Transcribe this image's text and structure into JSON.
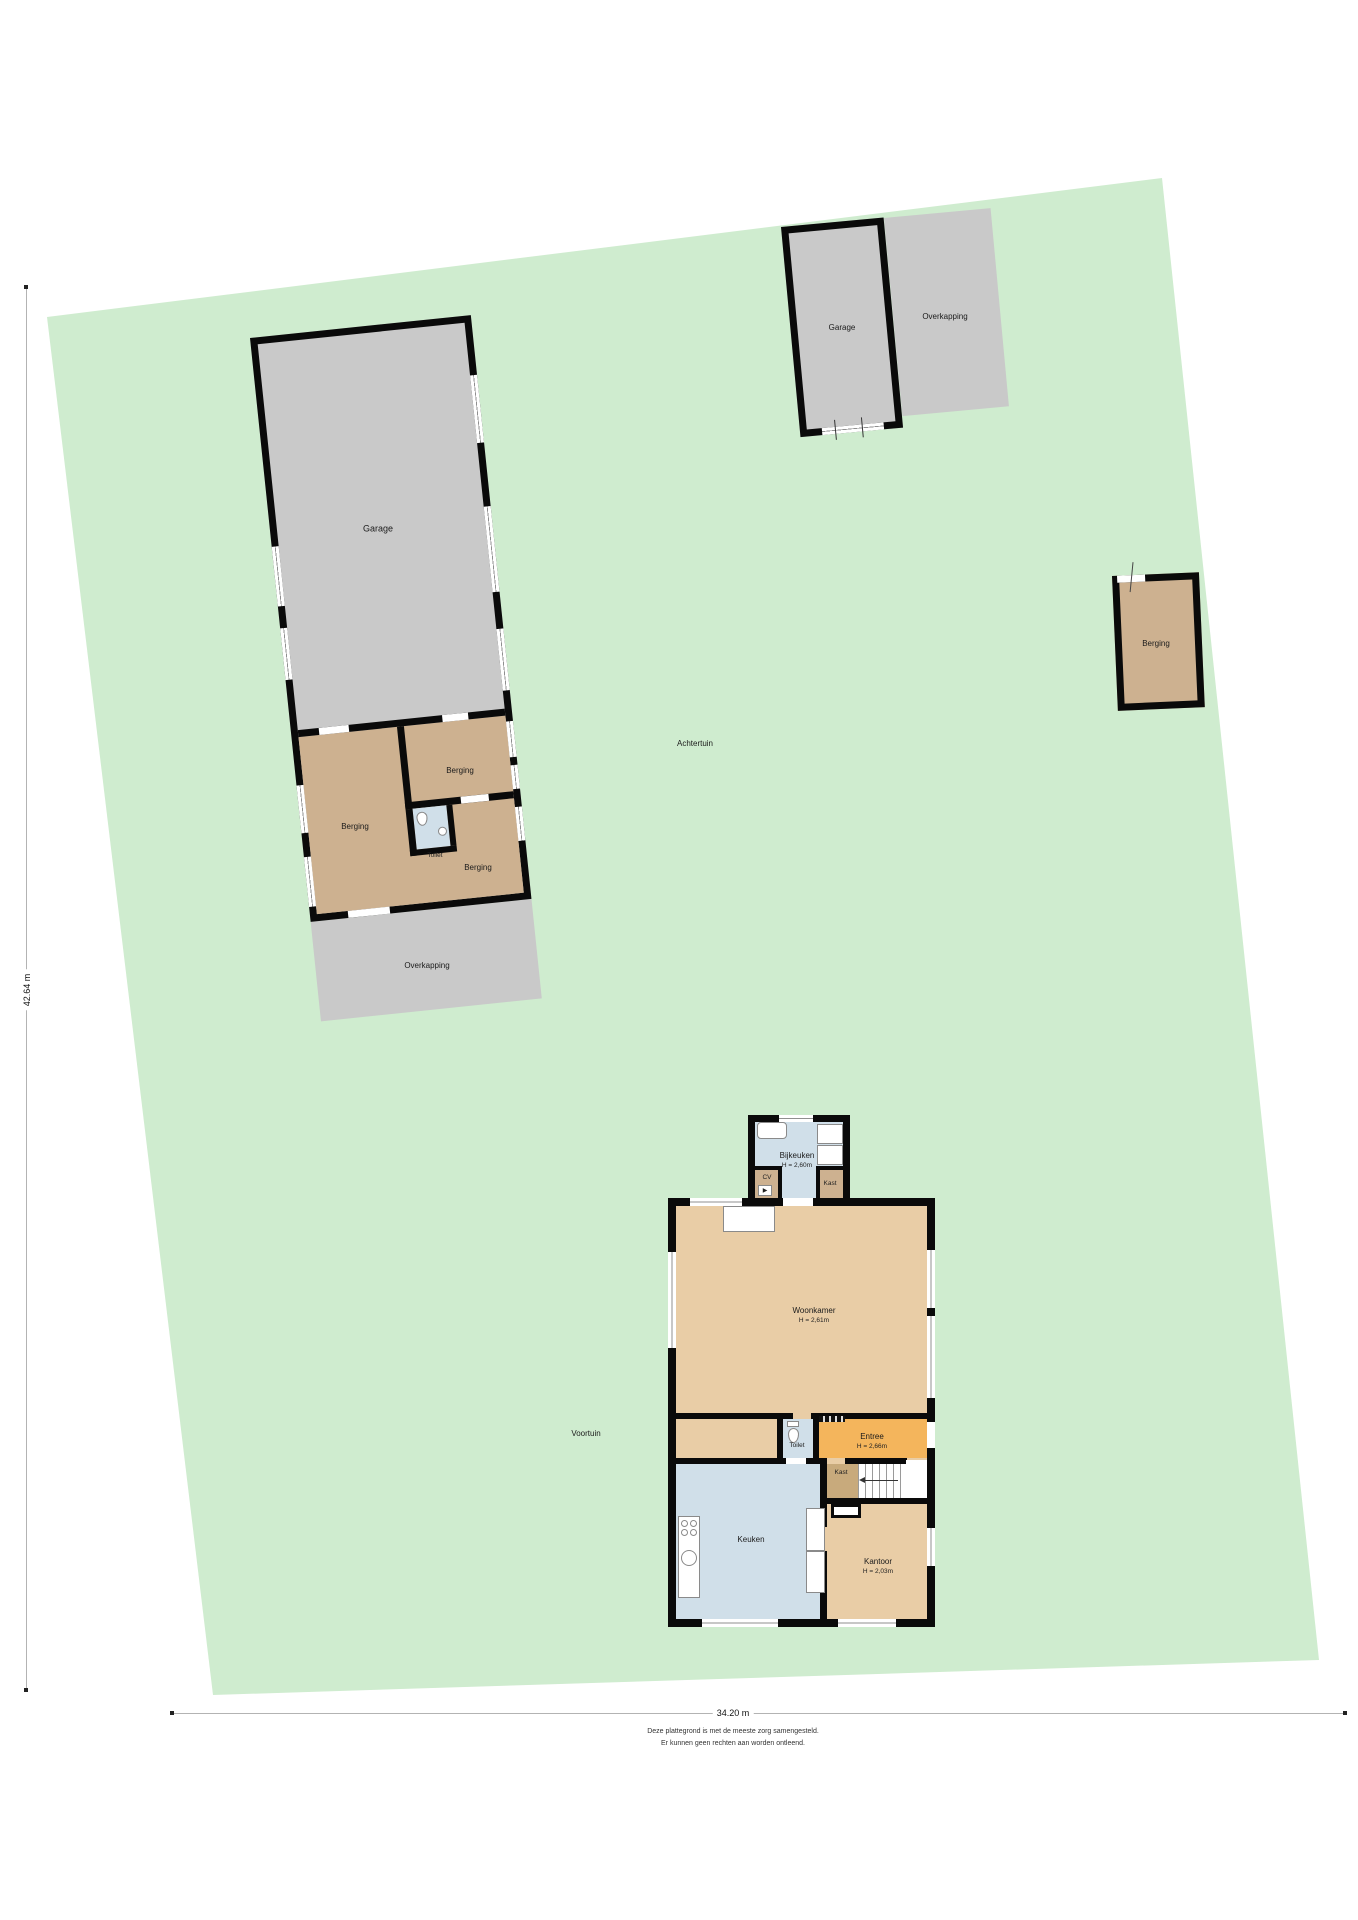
{
  "garden": {
    "achtertuin_label": "Achtertuin",
    "voortuin_label": "Voortuin"
  },
  "outbuilding_west": {
    "garage_label": "Garage",
    "berging_left_label": "Berging",
    "berging_top_right_label": "Berging",
    "berging_bottom_right_label": "Berging",
    "toilet_label": "Toilet",
    "overkapping_label": "Overkapping"
  },
  "outbuilding_north": {
    "garage_label": "Garage",
    "overkapping_label": "Overkapping"
  },
  "outbuilding_east": {
    "berging_label": "Berging"
  },
  "house": {
    "bijkeuken_label": "Bijkeuken",
    "bijkeuken_height": "H = 2,60m",
    "cv_label": "CV",
    "kast_top_label": "Kast",
    "woonkamer_label": "Woonkamer",
    "woonkamer_height": "H = 2,61m",
    "toilet_label": "Toilet",
    "entree_label": "Entree",
    "entree_height": "H = 2,66m",
    "kast_hall_label": "Kast",
    "keuken_label": "Keuken",
    "kantoor_label": "Kantoor",
    "kantoor_height": "H = 2,03m"
  },
  "dimensions": {
    "vertical": "42.64 m",
    "horizontal": "34.20 m"
  },
  "disclaimer": {
    "line1": "Deze plattegrond is met de meeste zorg samengesteld.",
    "line2": "Er kunnen geen rechten aan worden ontleend."
  },
  "colors": {
    "garden_green": "#cfeccf",
    "building_gray": "#c9c9c9",
    "storage_tan": "#cdb190",
    "house_tan": "#e9cda6",
    "closet_tan": "#c8aa7c",
    "wet_room_blue": "#d0dfe9",
    "entree_orange": "#f4b55c",
    "wall_black": "#0a0a0a"
  }
}
